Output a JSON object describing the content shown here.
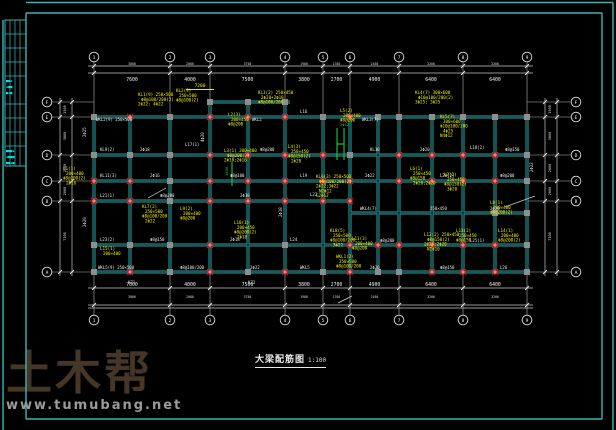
{
  "colors": {
    "background": "#000000",
    "border": "#38b6b6",
    "beam": "#2da3a3",
    "beam_core": "#001212",
    "column": "#8e8e8e",
    "red_node": "#c01212",
    "yellow": "#f2ee00",
    "white_text": "#e8e8e8",
    "green": "#1ec840",
    "dim_line": "#c9c9c9",
    "strip_text": "#00e6e6",
    "bubble_stroke": "#e0e0e0"
  },
  "watermark": {
    "logo": "土木帮",
    "url": "www.tumubang.net"
  },
  "title": {
    "text": "大梁配筋图",
    "scale": "1:100"
  },
  "title_strip": {
    "x": 5,
    "y": 20,
    "w": 21,
    "h": 146,
    "col_lines": [
      10,
      15,
      20
    ],
    "row_lines": [
      34,
      48,
      62,
      76,
      104,
      118,
      132,
      146
    ],
    "marks": [
      {
        "x": 6,
        "y": 82,
        "t": "■■▪"
      },
      {
        "x": 6,
        "y": 88,
        "t": "▪■■"
      },
      {
        "x": 6,
        "y": 94,
        "t": "■▪■"
      },
      {
        "x": 6,
        "y": 152,
        "t": "■■■▪"
      },
      {
        "x": 6,
        "y": 158,
        "t": "▪■■■"
      },
      {
        "x": 6,
        "y": 164,
        "t": "■■▪■"
      }
    ]
  },
  "borders": [
    [
      26,
      2.5,
      613,
      2.5
    ],
    [
      613,
      2.5,
      613,
      430
    ],
    [
      3,
      20,
      3,
      430
    ],
    [
      26,
      13,
      602,
      13
    ],
    [
      602,
      13,
      602,
      419
    ],
    [
      26,
      419,
      602,
      419
    ],
    [
      26,
      13,
      26,
      419
    ]
  ],
  "drawing": {
    "axes": {
      "top": {
        "x": [
          94,
          170,
          210,
          285,
          323,
          350,
          399,
          463,
          527
        ],
        "labels": [
          "1",
          "2",
          "3",
          "4",
          "5",
          "6",
          "7",
          "8",
          "9"
        ],
        "cy": 57
      },
      "bottom": {
        "x": [
          94,
          170,
          210,
          285,
          323,
          350,
          399,
          463,
          527
        ],
        "labels": [
          "1",
          "2",
          "3",
          "4",
          "5",
          "6",
          "7",
          "8",
          "9"
        ],
        "cy": 320
      },
      "left": {
        "y": [
          102,
          117,
          155,
          181,
          201,
          272
        ],
        "labels": [
          "F",
          "E",
          "D",
          "C",
          "B",
          "A"
        ],
        "cx": 47
      },
      "right": {
        "y": [
          102,
          117,
          155,
          181,
          201,
          272
        ],
        "labels": [
          "F",
          "E",
          "D",
          "C",
          "B",
          "A"
        ],
        "cx": 576
      }
    },
    "dims": {
      "top": {
        "lines": [
          66,
          73
        ],
        "ext": [
          88,
          533
        ],
        "row1": [
          "3800",
          "2000",
          "3750",
          "1900",
          "1350",
          "2450",
          "3200",
          "3200"
        ],
        "row2": [
          "7600",
          "4000",
          "7500",
          "3800",
          "2700",
          "4900",
          "6400",
          "6400"
        ],
        "yellow_dim": {
          "x": 200,
          "y": 87,
          "t": "7200"
        }
      },
      "bottom": {
        "lines": [
          288,
          305,
          308
        ],
        "ext": [
          88,
          533
        ],
        "row1": [
          "7600",
          "4000",
          "7500",
          "3800",
          "2700",
          "4900",
          "6400",
          "6400"
        ],
        "row2": [
          "3800",
          "2000",
          "3750",
          "1900",
          "1350",
          "2450",
          "3200",
          "3200"
        ]
      },
      "left": {
        "lines": [
          60,
          72
        ],
        "ext": [
          98,
          276
        ],
        "spans": [
          "1500",
          "3800",
          "2600",
          "2000",
          "7100"
        ]
      },
      "right": {
        "lines": [
          545,
          557
        ],
        "ext": [
          98,
          276
        ],
        "spans": [
          "1500",
          "3800",
          "2600",
          "2000",
          "7100"
        ]
      }
    },
    "beams": {
      "h": [
        [
          210,
          102,
          290,
          102
        ],
        [
          94,
          117,
          527,
          117
        ],
        [
          94,
          155,
          527,
          155
        ],
        [
          94,
          181,
          527,
          181
        ],
        [
          94,
          201,
          350,
          201
        ],
        [
          350,
          213,
          527,
          213
        ],
        [
          94,
          245,
          527,
          245
        ],
        [
          94,
          272,
          527,
          272
        ]
      ],
      "v": [
        [
          94,
          117,
          272
        ],
        [
          130,
          117,
          272
        ],
        [
          170,
          117,
          272
        ],
        [
          210,
          102,
          272
        ],
        [
          248,
          102,
          272
        ],
        [
          285,
          102,
          272
        ],
        [
          323,
          117,
          272
        ],
        [
          350,
          117,
          272
        ],
        [
          378,
          117,
          272
        ],
        [
          399,
          117,
          272
        ],
        [
          432,
          117,
          272
        ],
        [
          463,
          117,
          272
        ],
        [
          495,
          117,
          272
        ],
        [
          527,
          117,
          272
        ]
      ],
      "green": [
        [
          337,
          128,
          337,
          160
        ],
        [
          344,
          128,
          344,
          160
        ],
        [
          337,
          144,
          344,
          144
        ],
        [
          232,
          162,
          232,
          186
        ]
      ]
    },
    "columns": [
      [
        210,
        102
      ],
      [
        248,
        102
      ],
      [
        285,
        102
      ],
      [
        94,
        117
      ],
      [
        170,
        117
      ],
      [
        323,
        117
      ],
      [
        378,
        117
      ],
      [
        399,
        117
      ],
      [
        432,
        117
      ],
      [
        463,
        117
      ],
      [
        495,
        117
      ],
      [
        527,
        117
      ],
      [
        94,
        155
      ],
      [
        130,
        155
      ],
      [
        170,
        155
      ],
      [
        350,
        155
      ],
      [
        527,
        155
      ],
      [
        170,
        181
      ],
      [
        527,
        181
      ],
      [
        170,
        201
      ],
      [
        495,
        213
      ],
      [
        527,
        213
      ],
      [
        94,
        245
      ],
      [
        130,
        245
      ],
      [
        170,
        245
      ],
      [
        285,
        245
      ],
      [
        527,
        245
      ],
      [
        94,
        272
      ],
      [
        170,
        272
      ],
      [
        248,
        272
      ],
      [
        323,
        272
      ],
      [
        378,
        272
      ],
      [
        399,
        272
      ],
      [
        527,
        272
      ]
    ],
    "red_nodes": [
      [
        130,
        117
      ],
      [
        210,
        117
      ],
      [
        248,
        117
      ],
      [
        285,
        117
      ],
      [
        350,
        117
      ],
      [
        210,
        155
      ],
      [
        248,
        155
      ],
      [
        285,
        155
      ],
      [
        323,
        155
      ],
      [
        399,
        155
      ],
      [
        432,
        155
      ],
      [
        463,
        155
      ],
      [
        495,
        155
      ],
      [
        94,
        181
      ],
      [
        130,
        181
      ],
      [
        210,
        181
      ],
      [
        248,
        181
      ],
      [
        285,
        181
      ],
      [
        323,
        181
      ],
      [
        350,
        181
      ],
      [
        399,
        181
      ],
      [
        432,
        181
      ],
      [
        463,
        181
      ],
      [
        495,
        181
      ],
      [
        94,
        201
      ],
      [
        130,
        201
      ],
      [
        210,
        201
      ],
      [
        248,
        201
      ],
      [
        285,
        201
      ],
      [
        323,
        201
      ],
      [
        350,
        201
      ],
      [
        210,
        245
      ],
      [
        350,
        245
      ],
      [
        378,
        245
      ],
      [
        399,
        245
      ],
      [
        432,
        245
      ],
      [
        463,
        245
      ],
      [
        495,
        245
      ],
      [
        130,
        272
      ],
      [
        210,
        272
      ],
      [
        285,
        272
      ],
      [
        350,
        272
      ],
      [
        432,
        272
      ],
      [
        463,
        272
      ],
      [
        495,
        272
      ]
    ],
    "annotations": {
      "yellow": [
        {
          "x": 138,
          "y": 96,
          "lines": [
            "KL1(9) 250×500",
            "Φ8@100/200(2)",
            "2Φ22; 4Φ22"
          ]
        },
        {
          "x": 176,
          "y": 92,
          "lines": [
            "KL2(9)",
            "250×500",
            "Φ8@100(2)"
          ]
        },
        {
          "x": 258,
          "y": 94,
          "lines": [
            "KL3(2) 250×450",
            "2Φ20+2Φ18",
            "Φ8@100/200"
          ]
        },
        {
          "x": 415,
          "y": 94,
          "lines": [
            "KL4(7) 300×600",
            "Φ10@100/200(2)",
            "3Φ25; 3Φ25"
          ]
        },
        {
          "x": 440,
          "y": 118,
          "lines": [
            "KL5(7)",
            "300×600",
            "Φ10@100/200",
            "4Φ25",
            "N4Φ12"
          ]
        },
        {
          "x": 63,
          "y": 170,
          "lines": [
            "L1(1)",
            "200×400",
            "Φ8@200(2)",
            "2Φ16"
          ]
        },
        {
          "x": 228,
          "y": 116,
          "lines": [
            "L2(3)",
            "200×450",
            "Φ8@200"
          ]
        },
        {
          "x": 224,
          "y": 152,
          "lines": [
            "L3(1) 200×400",
            "Φ8@200(2)",
            "2Φ18;2Φ16"
          ]
        },
        {
          "x": 288,
          "y": 148,
          "lines": [
            "L4(3)",
            "250×450",
            "Φ8@150(2)",
            "2Φ20"
          ]
        },
        {
          "x": 316,
          "y": 178,
          "lines": [
            "KL6(3) 250×500",
            "Φ8@100/200(2)",
            "2Φ22;3Φ22",
            "N2Φ12",
            "G2Φ12"
          ]
        },
        {
          "x": 340,
          "y": 112,
          "lines": [
            "L5(2)",
            "200×400",
            "Φ8@200"
          ]
        },
        {
          "x": 410,
          "y": 170,
          "lines": [
            "L6(1)",
            "250×450",
            "Φ8@150",
            "2Φ20;2Φ20"
          ]
        },
        {
          "x": 444,
          "y": 176,
          "lines": [
            "L7(2)",
            "250×450",
            "Φ8@150(2)",
            "3Φ20"
          ]
        },
        {
          "x": 490,
          "y": 204,
          "lines": [
            "L8(1)",
            "200×400",
            "Φ8@200(2)"
          ]
        },
        {
          "x": 142,
          "y": 208,
          "lines": [
            "KL7(2)",
            "250×500",
            "Φ8@100/200",
            "2Φ22"
          ]
        },
        {
          "x": 180,
          "y": 210,
          "lines": [
            "L9(2)",
            "200×400",
            "Φ8@200"
          ]
        },
        {
          "x": 234,
          "y": 224,
          "lines": [
            "L10(1)",
            "200×450",
            "Φ8@200(2)",
            "2Φ18"
          ]
        },
        {
          "x": 330,
          "y": 232,
          "lines": [
            "KL8(5)",
            "250×500",
            "Φ8@100/200",
            "3Φ22"
          ]
        },
        {
          "x": 352,
          "y": 240,
          "lines": [
            "L11(3)",
            "200×400",
            "Φ8@200"
          ]
        },
        {
          "x": 424,
          "y": 236,
          "lines": [
            "L12(2) 250×450",
            "Φ8@150(2)",
            "2Φ20;2Φ20",
            "N2Φ10"
          ]
        },
        {
          "x": 456,
          "y": 232,
          "lines": [
            "L13(2)",
            "250×450",
            "Φ8@150"
          ]
        },
        {
          "x": 498,
          "y": 232,
          "lines": [
            "L14(1)",
            "200×400",
            "Φ8@200(2)"
          ]
        },
        {
          "x": 336,
          "y": 258,
          "lines": [
            "WKL1(2)",
            "250×500",
            "Φ8@100/200"
          ]
        },
        {
          "x": 100,
          "y": 250,
          "lines": [
            "L15(1)",
            "200×400"
          ]
        }
      ],
      "white": [
        {
          "x": 96,
          "y": 121,
          "t": "WKL2(9) 250×500"
        },
        {
          "x": 252,
          "y": 121,
          "t": "WKL2"
        },
        {
          "x": 300,
          "y": 113,
          "t": "L16"
        },
        {
          "x": 362,
          "y": 121,
          "t": "WKL3(7)"
        },
        {
          "x": 100,
          "y": 151,
          "t": "KL9(2)"
        },
        {
          "x": 140,
          "y": 151,
          "t": "2Φ18"
        },
        {
          "x": 185,
          "y": 146,
          "t": "L17(1)"
        },
        {
          "x": 260,
          "y": 151,
          "t": "Φ8@200"
        },
        {
          "x": 370,
          "y": 151,
          "t": "KL10"
        },
        {
          "x": 420,
          "y": 151,
          "t": "2Φ20"
        },
        {
          "x": 470,
          "y": 149,
          "t": "L18(2)"
        },
        {
          "x": 505,
          "y": 151,
          "t": "Φ8@150"
        },
        {
          "x": 100,
          "y": 177,
          "t": "KL11(3)"
        },
        {
          "x": 150,
          "y": 177,
          "t": "2Φ16"
        },
        {
          "x": 230,
          "y": 177,
          "t": "Φ8@100"
        },
        {
          "x": 300,
          "y": 177,
          "t": "L19"
        },
        {
          "x": 365,
          "y": 177,
          "t": "2Φ22"
        },
        {
          "x": 440,
          "y": 177,
          "t": "L20(2)"
        },
        {
          "x": 500,
          "y": 177,
          "t": "Φ8@200"
        },
        {
          "x": 100,
          "y": 197,
          "t": "L21(1)"
        },
        {
          "x": 160,
          "y": 197,
          "t": "Φ8@200"
        },
        {
          "x": 240,
          "y": 197,
          "t": "2Φ18"
        },
        {
          "x": 310,
          "y": 196,
          "t": "L22"
        },
        {
          "x": 360,
          "y": 210,
          "t": "WKL4(7)"
        },
        {
          "x": 430,
          "y": 210,
          "t": "250×450"
        },
        {
          "x": 490,
          "y": 210,
          "t": "2Φ20"
        },
        {
          "x": 100,
          "y": 241,
          "t": "L23(2)"
        },
        {
          "x": 150,
          "y": 241,
          "t": "Φ8@150"
        },
        {
          "x": 230,
          "y": 241,
          "t": "2Φ18"
        },
        {
          "x": 290,
          "y": 241,
          "t": "L24"
        },
        {
          "x": 380,
          "y": 242,
          "t": "Φ8@200"
        },
        {
          "x": 470,
          "y": 242,
          "t": "L25(1)"
        },
        {
          "x": 98,
          "y": 269,
          "t": "WKL5(9) 250×500"
        },
        {
          "x": 180,
          "y": 269,
          "t": "Φ8@100/200"
        },
        {
          "x": 250,
          "y": 269,
          "t": "2Φ22"
        },
        {
          "x": 300,
          "y": 269,
          "t": "WKL5"
        },
        {
          "x": 370,
          "y": 269,
          "t": "2Φ20"
        },
        {
          "x": 440,
          "y": 269,
          "t": "Φ8@150"
        },
        {
          "x": 500,
          "y": 269,
          "t": "L26"
        },
        {
          "x": 128,
          "y": 284,
          "t": "KZ1"
        },
        {
          "x": 248,
          "y": 284,
          "t": "KZ2"
        },
        {
          "x": 86,
          "y": 137,
          "t": "2Φ25",
          "r": 1
        },
        {
          "x": 204,
          "y": 142,
          "t": "4Φ20",
          "r": 1
        },
        {
          "x": 282,
          "y": 217,
          "t": "2Φ18",
          "r": 1
        },
        {
          "x": 533,
          "y": 172,
          "t": "2Φ22",
          "r": 1
        },
        {
          "x": 86,
          "y": 227,
          "t": "2Φ20",
          "r": 1
        }
      ],
      "green_text": [
        {
          "x": 228,
          "y": 176,
          "t": "1800",
          "r": 1
        },
        {
          "x": 340,
          "y": 126,
          "t": "2Φ12"
        }
      ]
    },
    "misc_lines": [
      [
        338,
        303,
        352,
        296
      ],
      [
        505,
        207,
        535,
        196
      ],
      [
        148,
        198,
        166,
        188
      ]
    ]
  }
}
